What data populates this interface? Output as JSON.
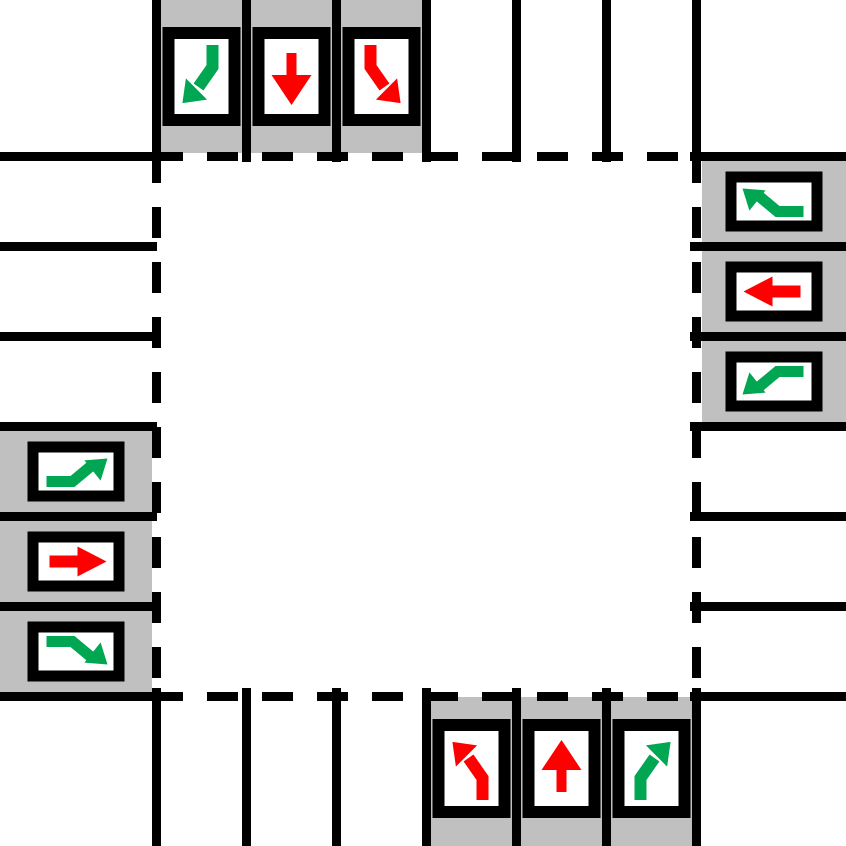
{
  "diagram": {
    "name": "four-way-intersection-lane-signal-diagram",
    "colors": {
      "background": "#ffffff",
      "road_line": "#000000",
      "signal_housing": "#c0c0c0",
      "signal_panel_border": "#000000",
      "signal_panel_face": "#ffffff",
      "green": "#00a651",
      "red": "#ff0000"
    },
    "intersection": {
      "boundary_style": "dashed",
      "lanes_per_road": 6,
      "signalized_lanes_per_approach": 3
    },
    "approaches": [
      {
        "side": "top",
        "direction_of_travel": "southbound",
        "signals": [
          {
            "lane": 1,
            "movement": "right-turn",
            "state": "green",
            "icon": "turn-arrow-down-left-icon"
          },
          {
            "lane": 2,
            "movement": "straight",
            "state": "red",
            "icon": "straight-arrow-down-icon"
          },
          {
            "lane": 3,
            "movement": "left-turn",
            "state": "red",
            "icon": "turn-arrow-down-right-icon"
          }
        ]
      },
      {
        "side": "right",
        "direction_of_travel": "westbound",
        "signals": [
          {
            "lane": 1,
            "movement": "right-turn",
            "state": "green",
            "icon": "turn-arrow-up-left-icon"
          },
          {
            "lane": 2,
            "movement": "straight",
            "state": "red",
            "icon": "straight-arrow-left-icon"
          },
          {
            "lane": 3,
            "movement": "left-turn",
            "state": "green",
            "icon": "turn-arrow-down-left-icon"
          }
        ]
      },
      {
        "side": "left",
        "direction_of_travel": "eastbound",
        "signals": [
          {
            "lane": 1,
            "movement": "left-turn",
            "state": "green",
            "icon": "turn-arrow-up-right-icon"
          },
          {
            "lane": 2,
            "movement": "straight",
            "state": "red",
            "icon": "straight-arrow-right-icon"
          },
          {
            "lane": 3,
            "movement": "right-turn",
            "state": "green",
            "icon": "turn-arrow-down-right-icon"
          }
        ]
      },
      {
        "side": "bottom",
        "direction_of_travel": "northbound",
        "signals": [
          {
            "lane": 1,
            "movement": "left-turn",
            "state": "red",
            "icon": "turn-arrow-up-left-icon"
          },
          {
            "lane": 2,
            "movement": "straight",
            "state": "red",
            "icon": "straight-arrow-up-icon"
          },
          {
            "lane": 3,
            "movement": "right-turn",
            "state": "green",
            "icon": "turn-arrow-up-right-icon"
          }
        ]
      }
    ]
  }
}
